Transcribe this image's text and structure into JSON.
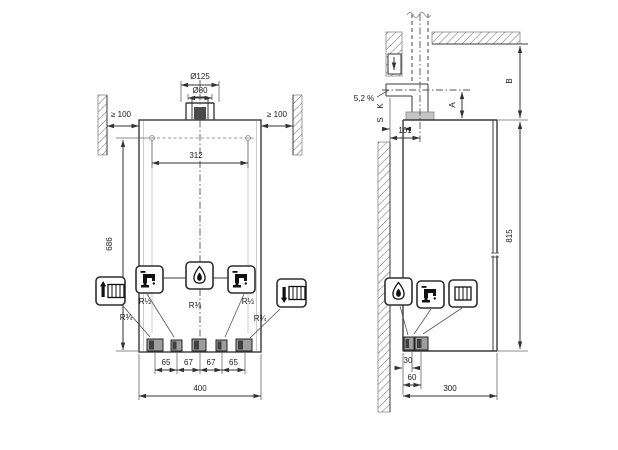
{
  "front": {
    "flue_outer_dia": "Ø125",
    "flue_inner_dia": "Ø80",
    "clearance_left": "≥ 100",
    "clearance_right": "≥ 100",
    "mount_hole_spacing": "312",
    "body_height": "686",
    "body_width": "400",
    "stub_spacings": [
      "65",
      "67",
      "67",
      "65"
    ],
    "connections": [
      {
        "icon": "radiator-flow-icon",
        "label": "R¾"
      },
      {
        "icon": "hot-water-tap-icon",
        "label": "R½"
      },
      {
        "icon": "gas-flame-icon",
        "label": "R¾"
      },
      {
        "icon": "cold-water-tap-icon",
        "label": "R½"
      },
      {
        "icon": "radiator-return-icon",
        "label": "R¾"
      }
    ]
  },
  "side": {
    "flue_slope": "5,2 %",
    "dim_label_a": "A",
    "dim_label_b": "B",
    "dim_label_k": "K",
    "dim_label_s": "S",
    "wall_to_flue_axis": "101",
    "total_height": "815",
    "rear_stub_offset_1": "30",
    "rear_stub_offset_2": "60",
    "body_depth": "300",
    "icons": [
      "gas-flame-icon",
      "tap-icon",
      "radiator-icon"
    ]
  },
  "colors": {
    "line": "#3a3a3a",
    "text": "#1a1a1a",
    "collar_fill": "#c4c4c4",
    "stub_fill": "#9e9e9e",
    "stub_dark": "#3f3f3f",
    "background": "#ffffff"
  }
}
